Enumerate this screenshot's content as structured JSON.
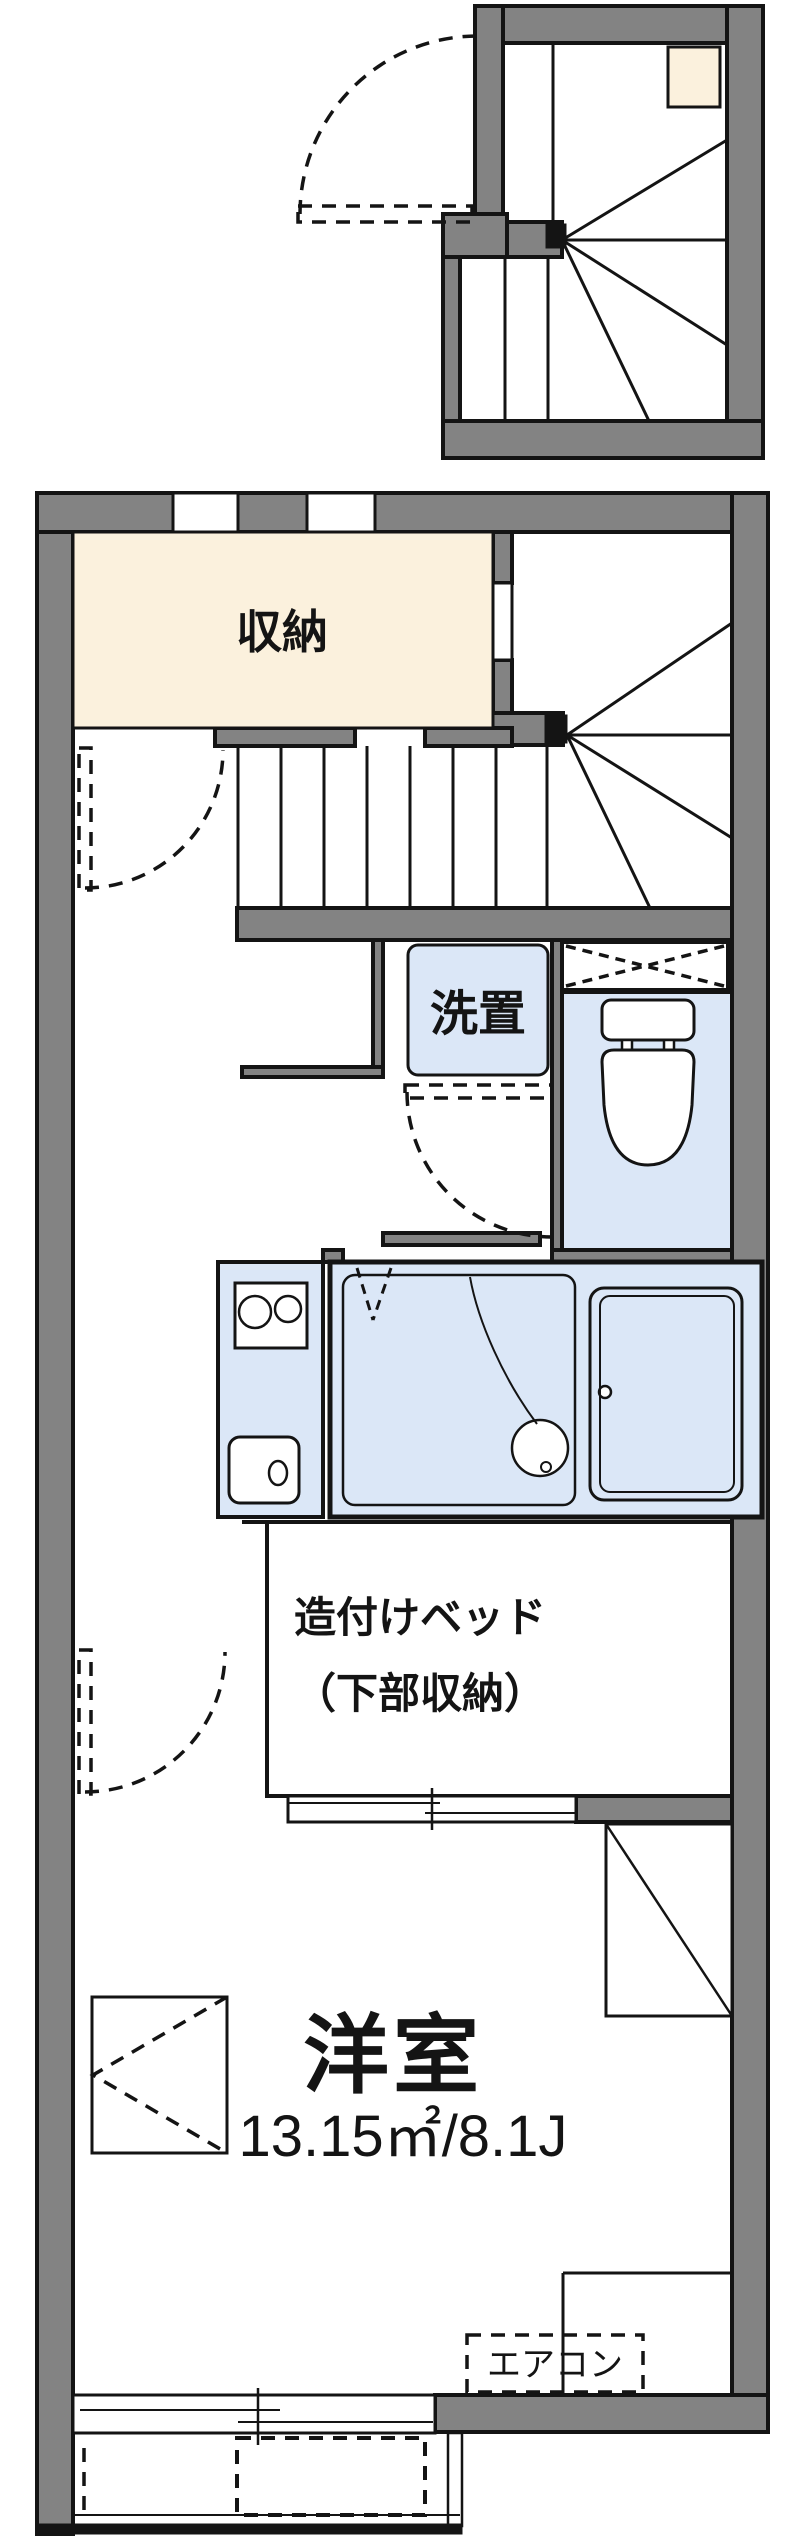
{
  "plan": {
    "type": "apartment-floor-plan",
    "labels": {
      "storage": "収納",
      "laundry": "洗置",
      "bed_line1": "造付けベッド",
      "bed_line2": "（下部収納）",
      "room_name": "洋室",
      "room_size": "13.15㎡/8.1J",
      "aircon": "エアコン"
    },
    "colors": {
      "wall": "#838383",
      "line": "#141414",
      "storage_fill": "#fbf1dd",
      "fixture_fill": "#dbe7f7",
      "background": "#ffffff"
    }
  }
}
